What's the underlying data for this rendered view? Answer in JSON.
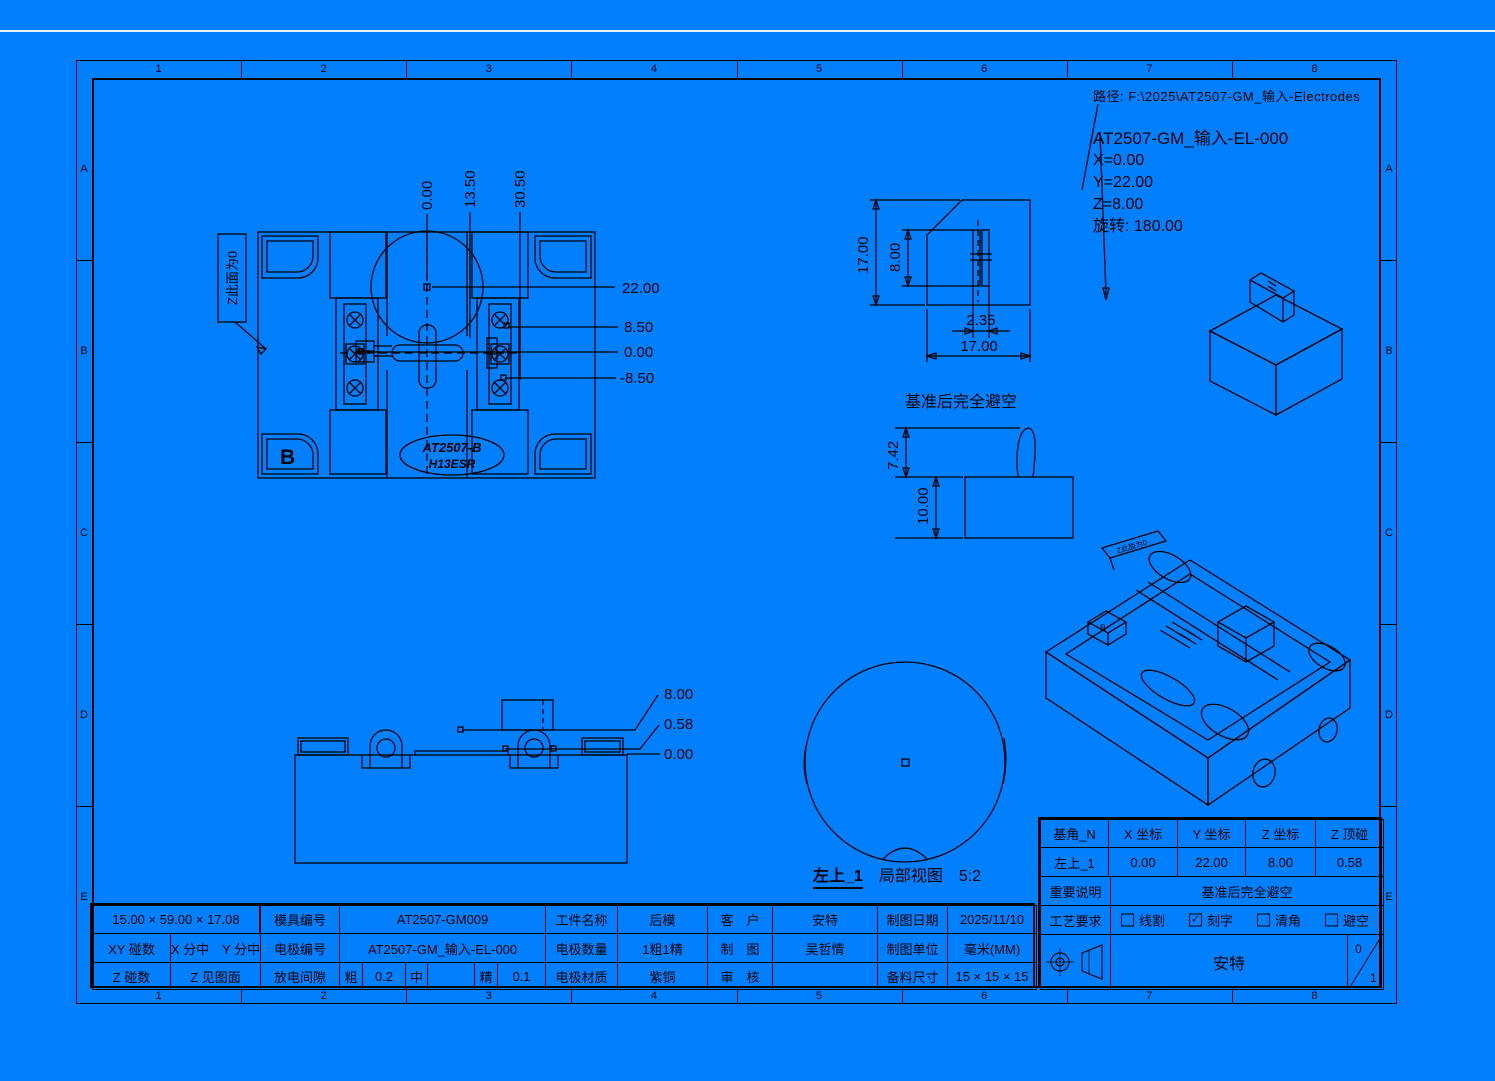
{
  "colors": {
    "bg": "#0080FF",
    "line": "#000000",
    "accent": "#C000C0",
    "marker": "#3C3CC8",
    "highlight": "#E8E8E8"
  },
  "path_bar": {
    "label": "路径: F:\\2025\\AT2507-GM_输入-Electrodes"
  },
  "part_info": {
    "title": "AT2507-GM_输入-EL-000",
    "x": "X=0.00",
    "y": "Y=22.00",
    "z": "Z=8.00",
    "rotation": "旋转: 180.00"
  },
  "frame": {
    "cols": [
      "1",
      "2",
      "3",
      "4",
      "5",
      "6",
      "7",
      "8"
    ],
    "rows": [
      "A",
      "B",
      "C",
      "D",
      "E"
    ]
  },
  "plan_view": {
    "face_note": "Z此面为0",
    "corner_mark": "B",
    "engrave_line1": "AT2507-B",
    "engrave_line2": "H13ESR",
    "dim_top": [
      "0.00",
      "13.50",
      "30.50"
    ],
    "dim_right": [
      "22.00",
      "8.50",
      "0.00",
      "-8.50"
    ]
  },
  "front_view": {
    "dim_height": "17.00",
    "dim_pocket_height": "8.00",
    "dim_slot_width": "2.35",
    "dim_width": "17.00"
  },
  "clearance_view": {
    "title": "基准后完全避空",
    "dim_offset": "7.42",
    "dim_height": "10.00"
  },
  "side_view": {
    "dim_top": "8.00",
    "dim_step": "0.58",
    "dim_zero": "0.00"
  },
  "detail_view": {
    "name": "左上_1",
    "kind": "局部视图",
    "scale": "5:2"
  },
  "iso_view": {
    "flag_note": "Z此面为0",
    "corner_mark": "B"
  },
  "title_block": {
    "size": "15.00 × 59.00 × 17.08",
    "mold_no_label": "模具编号",
    "mold_no": "AT2507-GM009",
    "part_name_label": "工件名称",
    "part_name": "后模",
    "customer_label": "客　户",
    "customer": "安特",
    "date_label": "制图日期",
    "date": "2025/11/10",
    "xy_label": "XY 碰数",
    "xy_value": "X 分中　Y 分中",
    "electrode_no_label": "电极编号",
    "electrode_no": "AT2507-GM_输入-EL-000",
    "qty_label": "电极数量",
    "qty": "1粗1精",
    "drafter_label": "制　图",
    "drafter": "吴哲情",
    "unit_label": "制图单位",
    "unit": "毫米(MM)",
    "z_label": "Z 碰数",
    "z_value": "Z 见图面",
    "gap_label": "放电间隙",
    "gap_rough_label": "粗",
    "gap_rough": "0.2",
    "gap_mid_label": "中",
    "gap_mid": "",
    "gap_fine_label": "精",
    "gap_fine": "0.1",
    "material_label": "电极材质",
    "material": "紫铜",
    "checker_label": "审　核",
    "checker": "",
    "stock_label": "备料尺寸",
    "stock": "15 × 15 × 15"
  },
  "datum_table": {
    "headers": [
      "基角_N",
      "X 坐标",
      "Y 坐标",
      "Z 坐标",
      "Z 顶碰"
    ],
    "values": [
      "左上_1",
      "0.00",
      "22.00",
      "8.00",
      "0.58"
    ],
    "note_label": "重要说明",
    "note_value": "基准后完全避空",
    "process_label": "工艺要求",
    "options": [
      {
        "label": "线割",
        "mark": ""
      },
      {
        "label": "刻字",
        "mark": "✓"
      },
      {
        "label": "清角",
        "mark": ""
      },
      {
        "label": "避空",
        "mark": ""
      }
    ],
    "company": "安特",
    "sheet_top": "0",
    "sheet_bottom": "1"
  }
}
